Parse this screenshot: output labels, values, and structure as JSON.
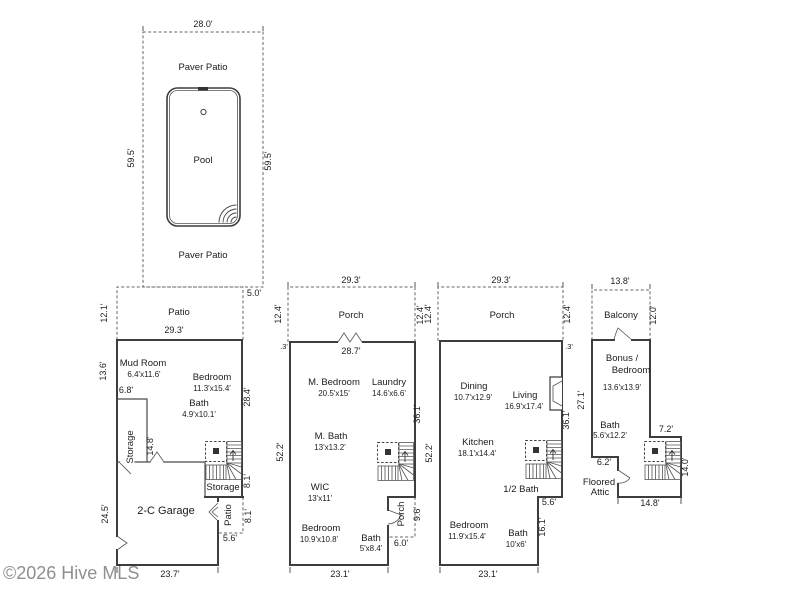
{
  "watermark": {
    "text": "©2026 Hive MLS"
  },
  "pool_area": {
    "width": "28.0'",
    "height_left": "59.5'",
    "height_right": "59.5'",
    "paver_patio_top": "Paver Patio",
    "paver_patio_bottom": "Paver Patio",
    "pool": "Pool"
  },
  "floor1": {
    "patio": "Patio",
    "patio_left": "12.1'",
    "patio_offset": "5.0'",
    "patio_width": "29.3'",
    "mud_room": "Mud Room",
    "mud_room_dims": "6.4'x11.6'",
    "wall_left_upper": "13.6'",
    "mud_wall": "6.8'",
    "bedroom": "Bedroom",
    "bedroom_dims": "11.3'x15.4'",
    "wall_right_upper": "28.4'",
    "bath": "Bath",
    "bath_dims": "4.9'x10.1'",
    "storage_room": "Storage",
    "storage_height": "14.8'",
    "storage_stairs": "Storage",
    "stair_wall": "8.1'",
    "garage": "2-C Garage",
    "wall_left_lower": "24.5'",
    "patio_rear": "Patio",
    "patio_rear_height": "8.1'",
    "patio_rear_width": "5.6'",
    "wall_bottom": "23.7'"
  },
  "floor2": {
    "porch": "Porch",
    "porch_width": "29.3'",
    "porch_left": "12.4'",
    "porch_right": "12.4'",
    "jog": ".3'",
    "wall_top": "28.7'",
    "m_bedroom": "M. Bedroom",
    "m_bedroom_dims": "20.5'x15'",
    "laundry": "Laundry",
    "laundry_dims": "14.6'x6.6'",
    "wall_right_upper": "36.1'",
    "wall_left": "52.2'",
    "m_bath": "M. Bath",
    "m_bath_dims": "13'x13.2'",
    "wic": "WIC",
    "wic_dims": "13'x11'",
    "porch_rear": "Porch",
    "porch_rear_height": "9.6'",
    "porch_rear_width": "6.0'",
    "bedroom": "Bedroom",
    "bedroom_dims": "10.9'x10.8'",
    "bath": "Bath",
    "bath_dims": "5'x8.4'",
    "wall_bottom": "23.1'"
  },
  "floor3": {
    "porch": "Porch",
    "porch_width": "29.3'",
    "porch_left": "12.4'",
    "porch_right": "12.4'",
    "jog": ".3'",
    "dining": "Dining",
    "dining_dims": "10.7'x12.9'",
    "living": "Living",
    "living_dims": "16.9'x17.4'",
    "wall_right_upper": "36.1'",
    "wall_left": "52.2'",
    "kitchen": "Kitchen",
    "kitchen_dims": "18.1'x14.4'",
    "half_bath": "1/2 Bath",
    "notch_width": "5.6'",
    "notch_height": "16.1'",
    "bedroom": "Bedroom",
    "bedroom_dims": "11.9'x15.4'",
    "bath": "Bath",
    "bath_dims": "10'x6'",
    "wall_bottom": "23.1'"
  },
  "floor4": {
    "balcony": "Balcony",
    "balcony_width": "13.8'",
    "balcony_height": "12.0'",
    "bonus_line1": "Bonus /",
    "bonus_line2": "Bedroom",
    "bonus_dims": "13.6'x13.9'",
    "wall_left": "27.1'",
    "bath": "Bath",
    "bath_dims": "5.6'x12.2'",
    "jut_width": "7.2'",
    "attic_wall": "6.2'",
    "attic_line1": "Floored",
    "attic_line2": "Attic",
    "wall_right_lower": "14.0'",
    "wall_bottom": "14.8'"
  }
}
